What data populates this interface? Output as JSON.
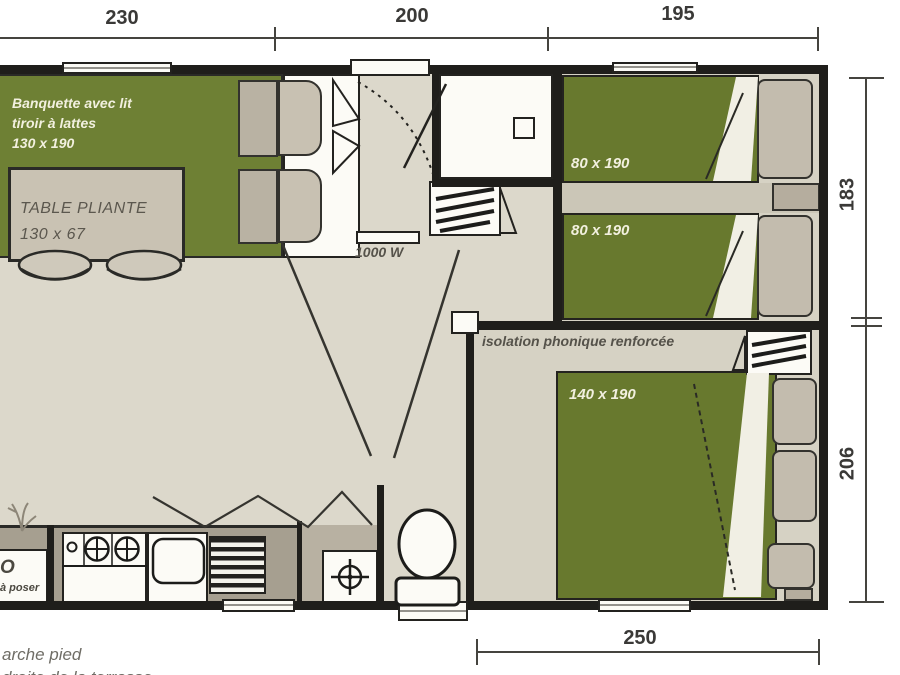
{
  "plan": {
    "dimensions": {
      "top_230": "230",
      "top_200": "200",
      "top_195": "195",
      "right_183": "183",
      "right_206": "206",
      "bottom_250": "250"
    },
    "living_room": {
      "banquette_line1": "Banquette avec lit",
      "banquette_line2": "tiroir à lattes",
      "banquette_line3": "130 x 190",
      "table_line1": "TABLE PLIANTE",
      "table_line2": "130 x 67"
    },
    "hallway": {
      "heater_label": "1000 W"
    },
    "twin_bedroom": {
      "bed1_label": "80 x 190",
      "bed2_label": "80 x 190"
    },
    "double_bedroom": {
      "bed_label": "140 x 190",
      "isolation_label": "isolation phonique renforcée"
    },
    "kitchen": {
      "fridge_line1": "O",
      "fridge_line2": "à poser"
    },
    "footnotes": {
      "line1": "arche pied",
      "line2": "droite de la terrasse"
    }
  },
  "colors": {
    "wall": "#1f1e1b",
    "floor": "#dcd8cb",
    "floor_bedroom": "#d6d2c4",
    "counter": "#a69f90",
    "sofa_green": "#6e8034",
    "bed_green": "#68792e",
    "cushion_gray": "#b9b2a3",
    "dim_text": "#3a3937",
    "label_dark": "#55524a",
    "label_light": "#f2f0df"
  }
}
